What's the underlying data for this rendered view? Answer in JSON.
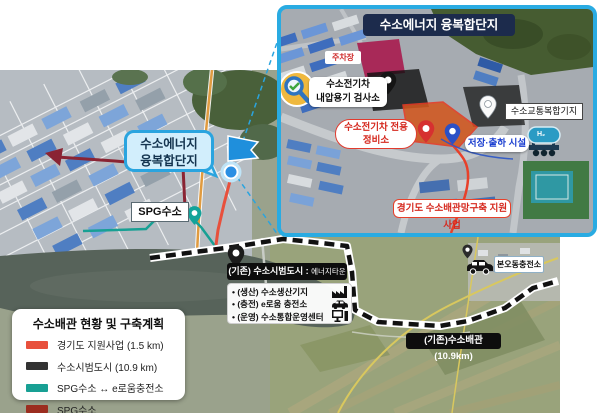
{
  "inset": {
    "title": "수소에너지 융복합단지",
    "parking_label": "주차장",
    "inspection_line1": "수소전기차",
    "inspection_line2": "내압용기 검사소",
    "repair_line1": "수소전기차 전용",
    "repair_line2": "정비소",
    "hub_label": "수소교통복합기지",
    "storage_label": "저장·출하 시설",
    "tank_text": "H₂",
    "project_label": "경기도 수소배관망구축 지원사업",
    "border_color": "#29abe2",
    "title_bg_color": "#1c2b4c"
  },
  "map": {
    "callout_line1": "수소에너지",
    "callout_line2": "융복합단지",
    "spg_label": "SPG수소",
    "pilot_city_prefix": "(기존) 수소시범도시 :",
    "pilot_city_suffix": "에너지타운",
    "pilot_items": [
      "• (생산) 수소생산기지",
      "• (충전) e로움 충전소",
      "• (운영) 수소통합운영센터"
    ],
    "bono_station_label": "본오동충전소",
    "existing_pipeline_label": "(기존)수소배관(10.9km)"
  },
  "legend": {
    "title": "수소배관 현황 및 구축계획",
    "items": [
      {
        "color": "#e8503c",
        "label": "경기도 지원사업 (1.5 km)"
      },
      {
        "color": "#333333",
        "label": "수소시범도시 (10.9 km)"
      },
      {
        "color": "#18a094",
        "label": "SPG수소 ↔ e로움충전소"
      },
      {
        "color": "#9b2d1f",
        "label": "SPG수소"
      }
    ]
  },
  "route_colors": {
    "gyeonggi_support": "#e8503c",
    "pilot_city_pipeline": "#111111",
    "spg_eroum": "#18a094",
    "spg": "#8a2433"
  }
}
